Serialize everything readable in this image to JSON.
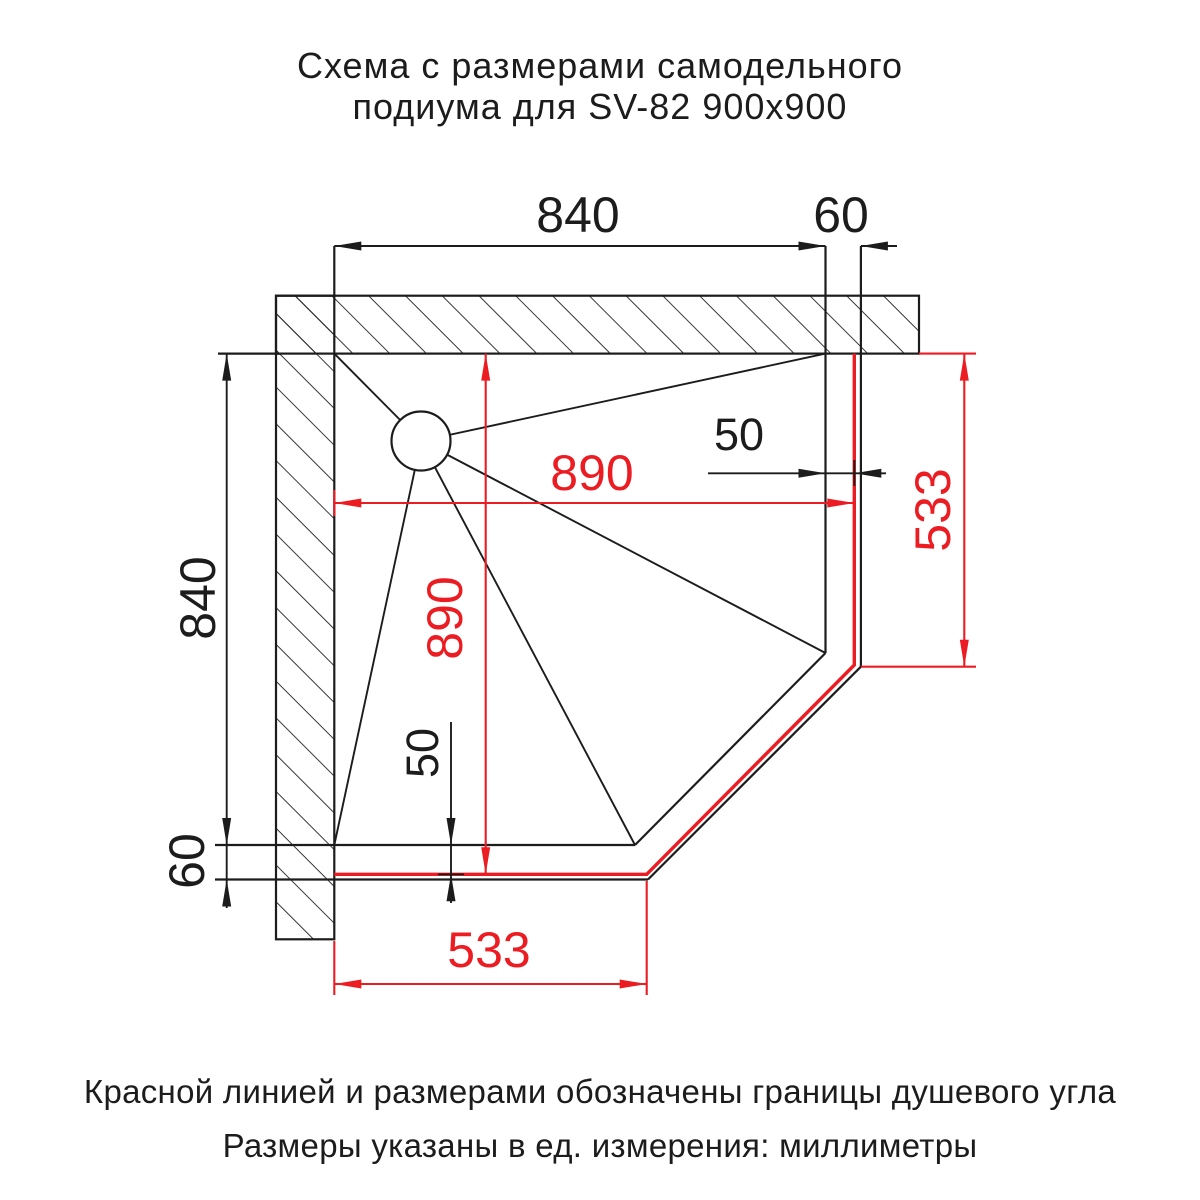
{
  "title": {
    "line1": "Схема с размерами самодельного",
    "line2": "подиума для SV-82 900x900"
  },
  "footer": {
    "note1": "Красной линией и размерами обозначены границы душевого угла",
    "note2": "Размеры указаны в ед. измерения: миллиметры"
  },
  "colors": {
    "ink": "#1c1c1c",
    "red": "#ec1c23",
    "background": "#ffffff"
  },
  "dims": {
    "podium_width": "840",
    "podium_edge_right": "60",
    "podium_height": "840",
    "podium_edge_bottom": "60",
    "shower_width": "890",
    "shower_height": "890",
    "gap_right": "50",
    "gap_bottom": "50",
    "chamfer_right": "533",
    "chamfer_bottom": "533"
  }
}
